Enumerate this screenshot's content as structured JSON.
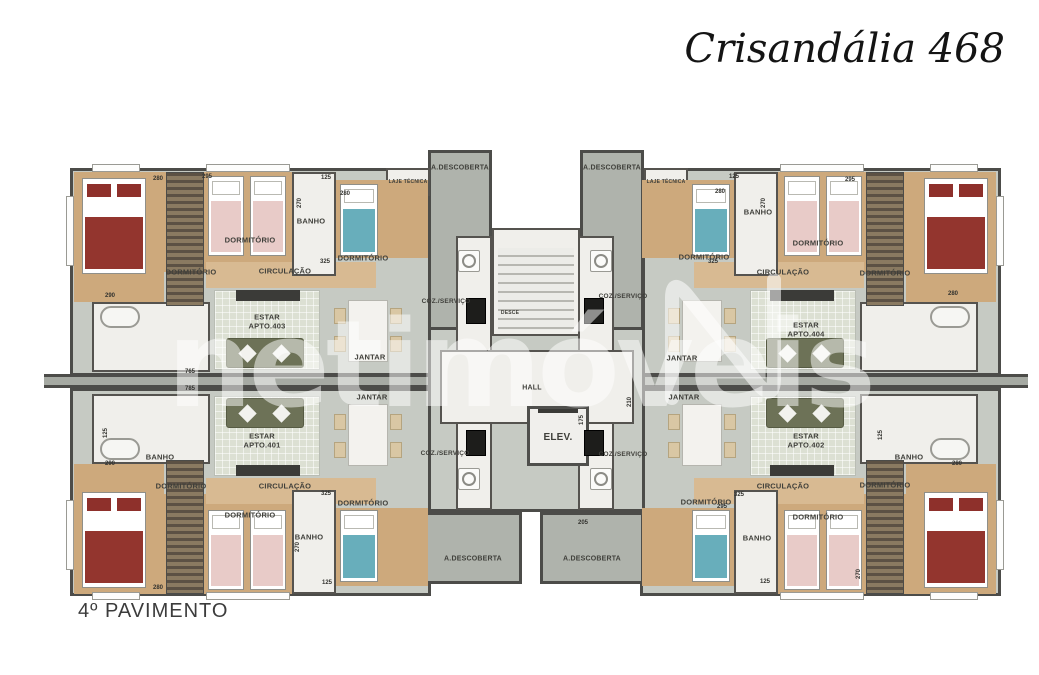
{
  "title": "Crisandália 468",
  "floor_label": "4º PAVIMENTO",
  "watermark": {
    "text": "netimóveis",
    "logo_icon": "n-outline-logo"
  },
  "colors": {
    "floor_gray": "#c6cac3",
    "terrace_gray": "#afb3ac",
    "wood": "#cda97c",
    "wall": "#4c4c49",
    "white_room": "#f0efeb",
    "teal_bed": "#68aebb",
    "pink_bed": "#e8cbc8",
    "red_bed": "#93352e",
    "sofa_olive": "#6d7257"
  },
  "rooms": [
    {
      "text": "DORMITÓRIO",
      "x": 250,
      "y": 240
    },
    {
      "text": "BANHO",
      "x": 311,
      "y": 221
    },
    {
      "text": "DORMITÓRIO",
      "x": 363,
      "y": 258
    },
    {
      "text": "DORMITÓRIO",
      "x": 191,
      "y": 272
    },
    {
      "text": "CIRCULAÇÃO",
      "x": 285,
      "y": 271
    },
    {
      "text": "ESTAR\nAPTO.403",
      "x": 267,
      "y": 322
    },
    {
      "text": "JANTAR",
      "x": 370,
      "y": 357
    },
    {
      "text": "COZ./SERVIÇO",
      "x": 446,
      "y": 302,
      "size": 6.5
    },
    {
      "text": "COZ./SERVIÇO",
      "x": 623,
      "y": 297,
      "size": 6.5
    },
    {
      "text": "COZ./SERVIÇO",
      "x": 445,
      "y": 454,
      "size": 6.5
    },
    {
      "text": "COZ./SERVIÇO",
      "x": 623,
      "y": 455,
      "size": 6.5
    },
    {
      "text": "A.DESCOBERTA",
      "x": 460,
      "y": 169,
      "size": 7
    },
    {
      "text": "A.DESCOBERTA",
      "x": 612,
      "y": 169,
      "size": 7
    },
    {
      "text": "A.DESCOBERTA",
      "x": 473,
      "y": 560,
      "size": 7
    },
    {
      "text": "A.DESCOBERTA",
      "x": 592,
      "y": 560,
      "size": 7
    },
    {
      "text": "LAJE TÉCNICA",
      "x": 408,
      "y": 182,
      "size": 5
    },
    {
      "text": "LAJE TÉCNICA",
      "x": 666,
      "y": 182,
      "size": 5
    },
    {
      "text": "HALL",
      "x": 532,
      "y": 389,
      "size": 7
    },
    {
      "text": "ELEV.",
      "x": 558,
      "y": 438,
      "size": 10
    },
    {
      "text": "DESCE",
      "x": 510,
      "y": 313,
      "size": 5
    },
    {
      "text": "BANHO",
      "x": 160,
      "y": 457
    },
    {
      "text": "ESTAR\nAPTO.401",
      "x": 262,
      "y": 441
    },
    {
      "text": "DORMITÓRIO",
      "x": 181,
      "y": 486
    },
    {
      "text": "CIRCULAÇÃO",
      "x": 285,
      "y": 486
    },
    {
      "text": "DORMITÓRIO",
      "x": 250,
      "y": 515
    },
    {
      "text": "DORMITÓRIO",
      "x": 363,
      "y": 503
    },
    {
      "text": "BANHO",
      "x": 309,
      "y": 537
    },
    {
      "text": "JANTAR",
      "x": 372,
      "y": 397
    },
    {
      "text": "DORMITÓRIO",
      "x": 704,
      "y": 257
    },
    {
      "text": "BANHO",
      "x": 758,
      "y": 212
    },
    {
      "text": "DORMITÓRIO",
      "x": 818,
      "y": 243
    },
    {
      "text": "DORMITÓRIO",
      "x": 885,
      "y": 273
    },
    {
      "text": "CIRCULAÇÃO",
      "x": 783,
      "y": 272
    },
    {
      "text": "ESTAR\nAPTO.404",
      "x": 806,
      "y": 330
    },
    {
      "text": "JANTAR",
      "x": 682,
      "y": 358
    },
    {
      "text": "ESTAR\nAPTO.402",
      "x": 806,
      "y": 441
    },
    {
      "text": "CIRCULAÇÃO",
      "x": 783,
      "y": 486
    },
    {
      "text": "DORMITÓRIO",
      "x": 885,
      "y": 485
    },
    {
      "text": "DORMITÓRIO",
      "x": 818,
      "y": 517
    },
    {
      "text": "BANHO",
      "x": 909,
      "y": 457
    },
    {
      "text": "DORMITÓRIO",
      "x": 706,
      "y": 502
    },
    {
      "text": "BANHO",
      "x": 757,
      "y": 538
    },
    {
      "text": "JANTAR",
      "x": 684,
      "y": 397
    }
  ],
  "dimensions": [
    {
      "text": "280",
      "x": 158,
      "y": 179
    },
    {
      "text": "295",
      "x": 207,
      "y": 177
    },
    {
      "text": "125",
      "x": 326,
      "y": 178
    },
    {
      "text": "270",
      "x": 300,
      "y": 203,
      "rot": -90
    },
    {
      "text": "280",
      "x": 345,
      "y": 194
    },
    {
      "text": "325",
      "x": 325,
      "y": 262
    },
    {
      "text": "290",
      "x": 110,
      "y": 296
    },
    {
      "text": "765",
      "x": 190,
      "y": 372
    },
    {
      "text": "785",
      "x": 190,
      "y": 389
    },
    {
      "text": "125",
      "x": 106,
      "y": 433,
      "rot": -90
    },
    {
      "text": "290",
      "x": 110,
      "y": 464
    },
    {
      "text": "270",
      "x": 298,
      "y": 547,
      "rot": -90
    },
    {
      "text": "325",
      "x": 326,
      "y": 494
    },
    {
      "text": "125",
      "x": 327,
      "y": 583
    },
    {
      "text": "280",
      "x": 158,
      "y": 588
    },
    {
      "text": "125",
      "x": 734,
      "y": 177
    },
    {
      "text": "280",
      "x": 720,
      "y": 192
    },
    {
      "text": "295",
      "x": 850,
      "y": 180
    },
    {
      "text": "270",
      "x": 764,
      "y": 203,
      "rot": -90
    },
    {
      "text": "325",
      "x": 713,
      "y": 262
    },
    {
      "text": "280",
      "x": 953,
      "y": 294
    },
    {
      "text": "125",
      "x": 881,
      "y": 435,
      "rot": -90
    },
    {
      "text": "280",
      "x": 957,
      "y": 464
    },
    {
      "text": "325",
      "x": 739,
      "y": 495
    },
    {
      "text": "295",
      "x": 722,
      "y": 507
    },
    {
      "text": "270",
      "x": 859,
      "y": 574,
      "rot": -90
    },
    {
      "text": "125",
      "x": 765,
      "y": 582
    },
    {
      "text": "210",
      "x": 630,
      "y": 402,
      "rot": -90
    },
    {
      "text": "175",
      "x": 582,
      "y": 420,
      "rot": -90
    },
    {
      "text": "205",
      "x": 583,
      "y": 523
    }
  ]
}
